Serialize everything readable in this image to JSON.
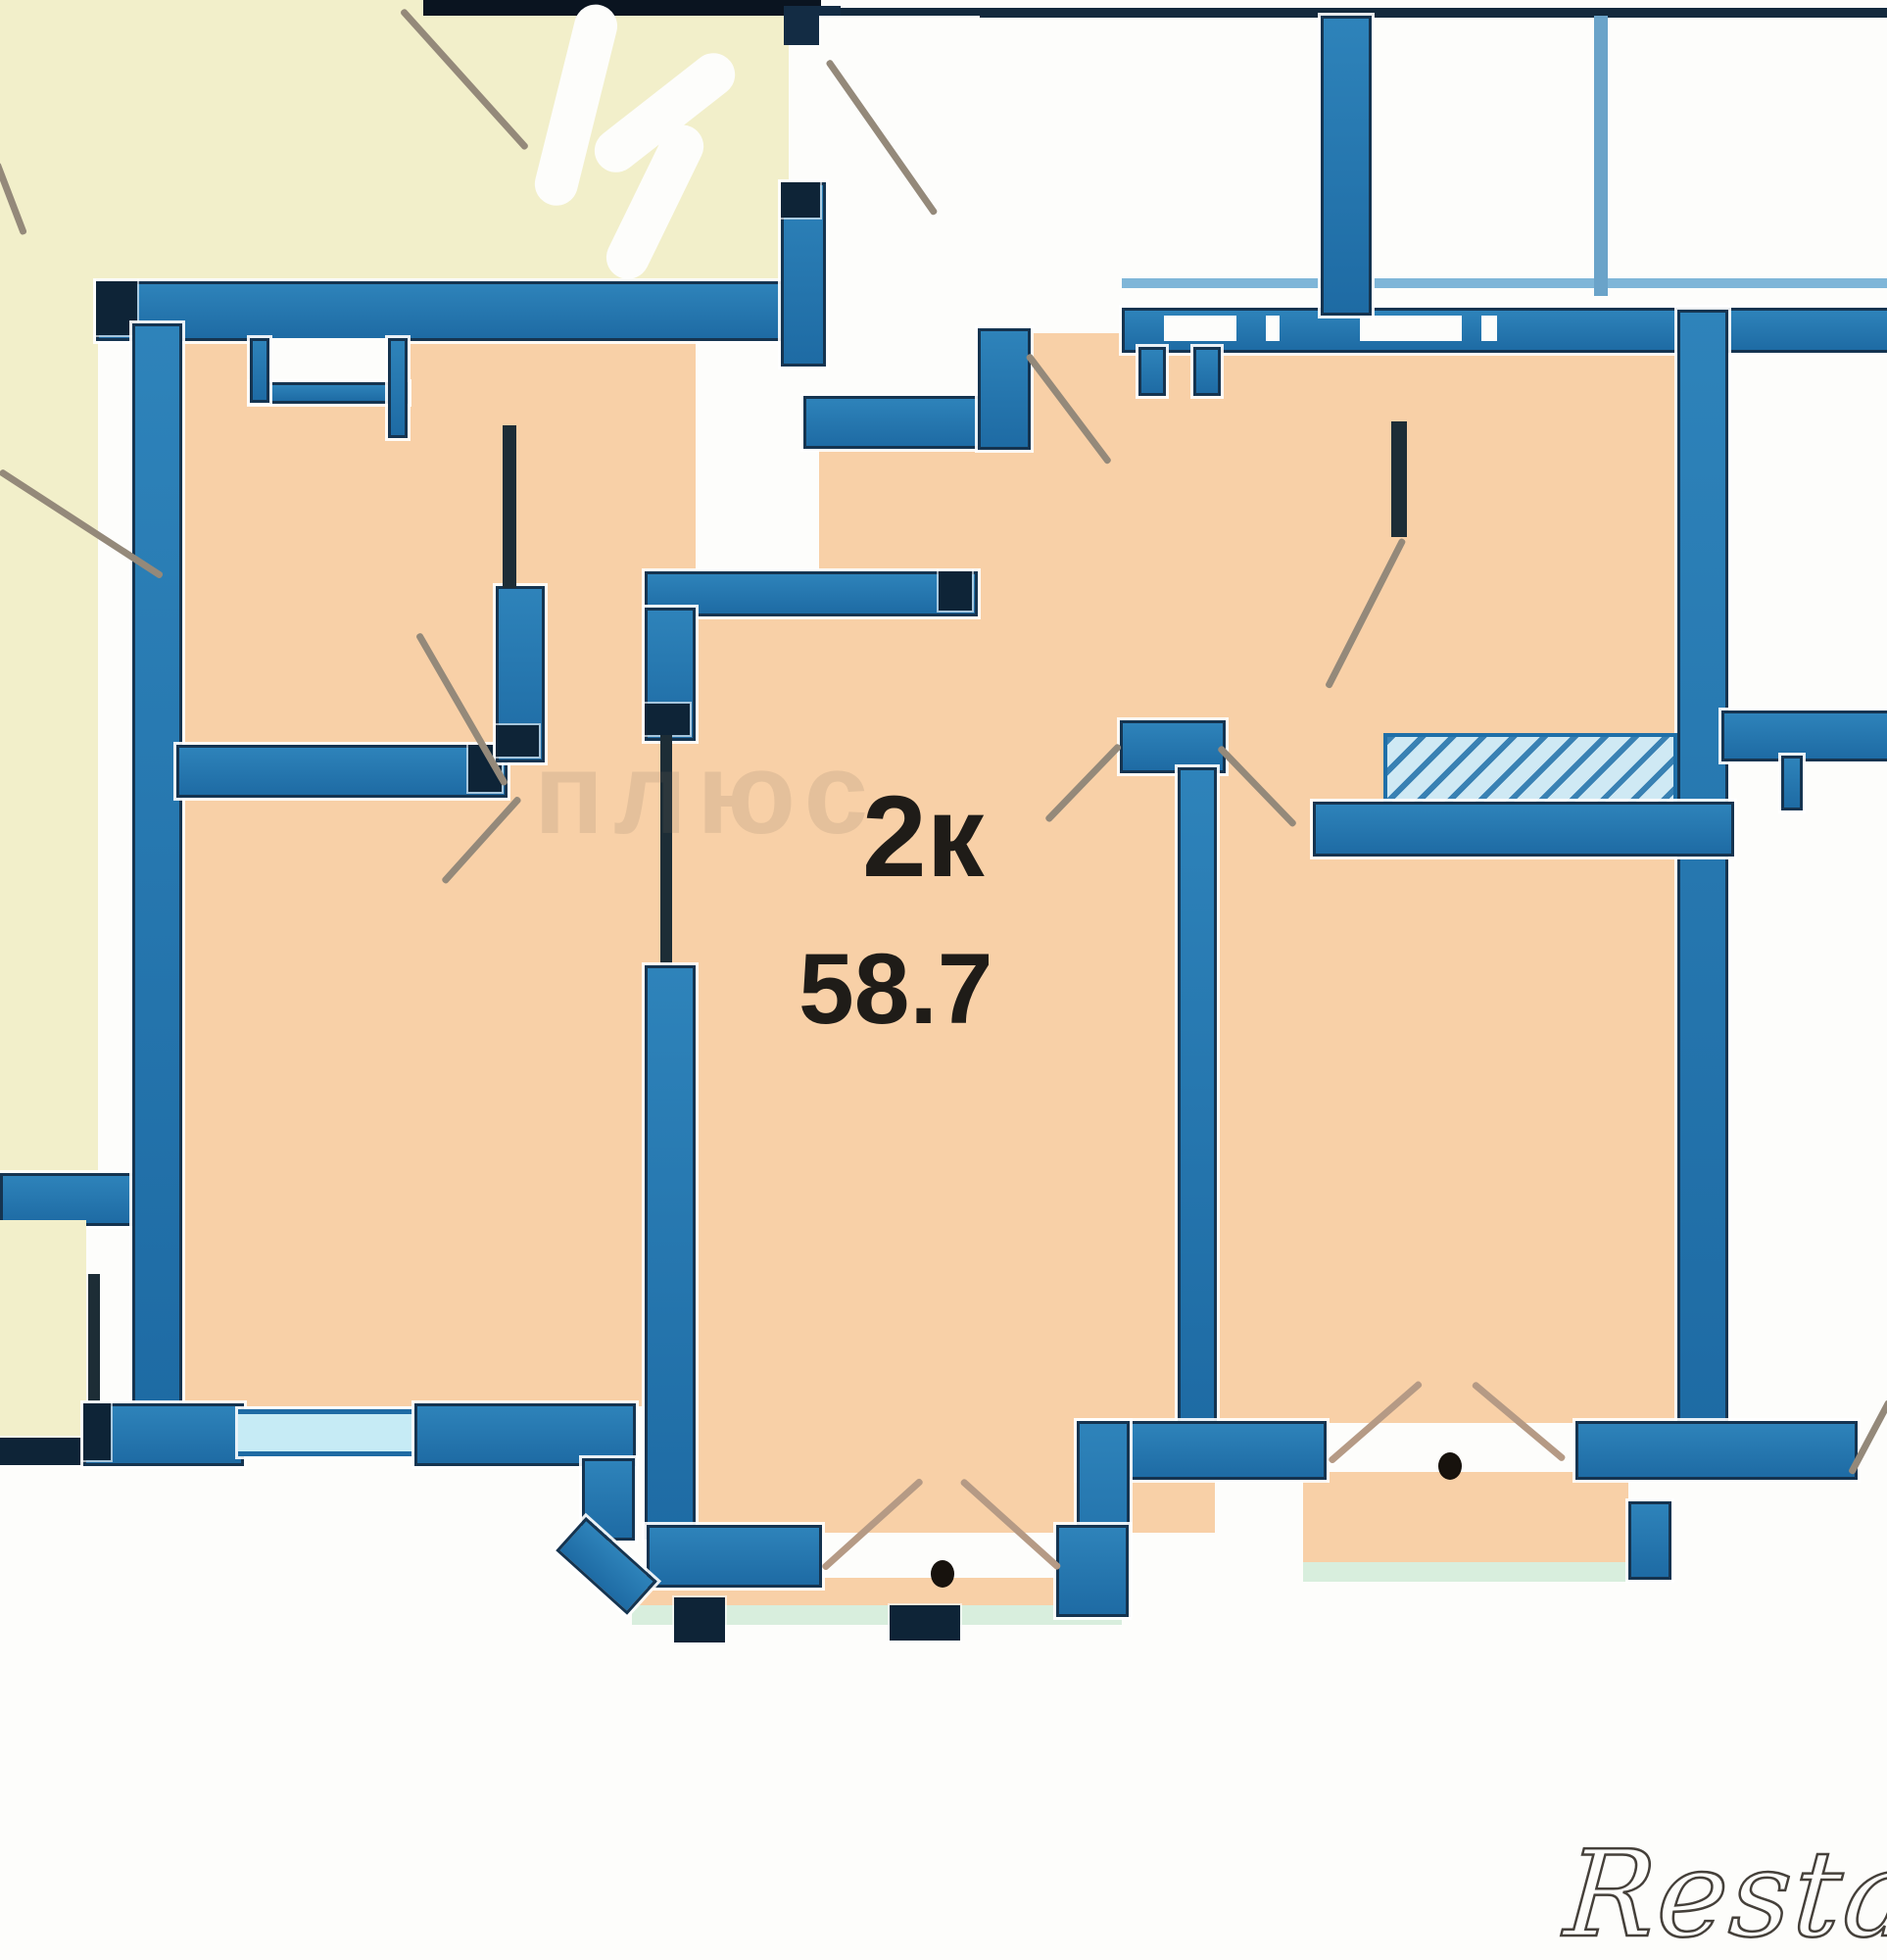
{
  "plan": {
    "type_label": "2к",
    "area_label": "58.7",
    "description": "2-room apartment floor plan, 58.7 sq.m, blue walls, peach rooms, cream neighbouring unit"
  },
  "watermarks": {
    "center": "плюс",
    "bottom_right": "Restate"
  },
  "colors": {
    "wall_blue": "#2173ab",
    "wall_dark": "#0e2437",
    "room_peach": "#f8d0a7",
    "neighbor_cream": "#f2efca",
    "window_cyan": "#c6ebf5",
    "balcony_teal": "#d8eedd",
    "door_line": "#94897a",
    "label_text": "#1f1c18"
  }
}
